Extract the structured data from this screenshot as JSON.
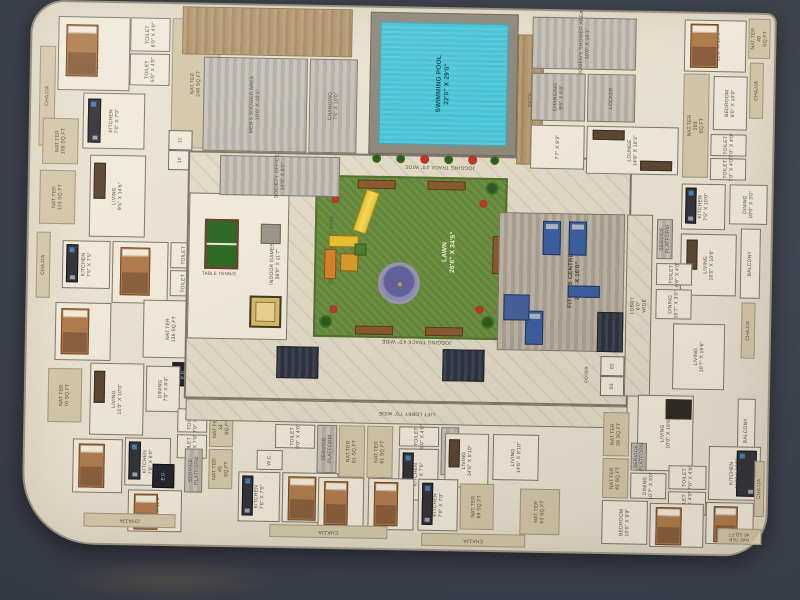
{
  "amen": {
    "pool": "SWIMMING POOL\n22'0\" X 29'0\"",
    "deck": "DECK",
    "lawn": "LAWN\n26'6\" X 34'5\"",
    "jog": "JOGGING TRACK 4'0\" WIDE",
    "indoor": "INDOOR GAMES\n38'0\" X 11'7\"",
    "tt": "TABLE TENNIS",
    "fitness": "FITNESS CENTRE\n24'0\" X 16'0\"",
    "mens": "MEN'S SHOWER AREA\n10'0\" X 10'1\"",
    "womens": "WOMEN'S SHOWER AREA\n10'0\" X 10'1\"",
    "chgm": "CHANGING\n7'5\" X 10'0\"",
    "chgw": "CHANGING\n9'5\" X 6'8\"",
    "locker": "LOCKER",
    "lounge": "LOUNGE\n14'8\" X 10'3\"",
    "office": "SOCIETY OFFICE\n14'0\" X 8'0\"",
    "r77": "7'7\" X 9'3\"",
    "liftlobby": "LIFT LOBBY 7'0\" WIDE",
    "lobby": "LOBBY 6'0\" WIDE",
    "foyer": "FOYER",
    "lift02": "02",
    "lift03": "03",
    "lift10": "10",
    "lift11": "11",
    "ed": "E.D."
  },
  "tl": {
    "bed": "BEDROOM\n10'0\" X 10'0\"",
    "kit": "KITCHEN\n7'0\" X 7'0\"",
    "t1": "TOILET\n6'0\" X 4'0\"",
    "t2": "TOILET\n5'0\" X 4'0\"",
    "nat248": "NAT.TER\n248 SQ.FT",
    "chajja": "CHAJJA"
  },
  "left": {
    "nat108": "NAT.TER\n108 SQ.FT",
    "nat113": "NAT.TER\n113 SQ.FT",
    "living": "LIVING\n9'5\" X 14'6\"",
    "kit": "KITCHEN\n7'5\" X 7'5\"",
    "bed": "BEDROOM\n9'0\" X 10'0\"",
    "t1": "TOILET\n6'0\" X 4'0\"",
    "t2": "TOILET\n7'0\" X 4'0\"",
    "nat136": "NAT.TER\n136 SQ.FT",
    "bed2": "BEDROOM\n10'0\" X 10'0\"",
    "chajja": "CHAJJA"
  },
  "bl": {
    "nat70": "NAT.TER\n70 SQ.FT",
    "living": "LIVING\n15'0\" X 10'0\"",
    "dining": "DINING\n7'0\" X 8'0\"",
    "kit": "KITCHEN\n7'8\" X 8'0\"",
    "bed1": "BEDROOM\n9'0\" X 8'0\"",
    "bed2": "BED ROOM\n10'0\" X 11'3\"",
    "t1": "TOILET\n7'0\" X 4'0\"",
    "t2": "TOILET\n4'0\" X 7'0\"",
    "nat34": "NAT.TER\n34 SQ.FT",
    "nat45": "NAT.TER\n45 SQ.FT",
    "sp": "SERVICE\nPLATFORM",
    "chajja": "CHAJJA"
  },
  "bm": {
    "t1": "TOILET\n8'0\" X 4'0\"",
    "sp1": "SERVICE\nPLATFORM",
    "nat81a": "NAT.TER\n81 SQ.FT",
    "nat81b": "NAT.TER\n81 SQ.FT",
    "wc": "W.C.",
    "kit1": "KITCHEN\n7'8\" X 7'0\"",
    "bed": "BEDROOM\n10'0\" X 10'0\"",
    "living1": "LIVING\n14'6\" X 8'10\"",
    "living2": "LIVING\n14'6\" X 8'10\"",
    "kit2": "KITCHEN\n7'5\" X 7'0\"",
    "t2": "TOILET\n6'0\" X 4'0\"",
    "sp2": "SERVICE\nPLATFORM"
  },
  "bm2": {
    "bed1": "BEDROOM\n10'0\" X 8'0\"",
    "bed2": "BEDROOM\n10'0\" X 8'0\"",
    "kit": "KITCHEN\n7'0\" X 7'0\"",
    "chajja1": "CHAJJA",
    "chajja2": "CHAJJA",
    "nat69": "NAT.TER\n69 SQ.FT",
    "nat83": "NAT.TER\n83 SQ.FT"
  },
  "br": {
    "living": "LIVING\n10'0\" X 16'6\"",
    "balcony": "BALCONY",
    "dining": "DINING\n10'7\" X 3'0\"",
    "nat39": "NAT.TER\n39 SQ.FT",
    "nat45": "NAT.TER\n45 SQ.FT",
    "sp": "SERVICE\nPLATFORM",
    "t1": "TOILET\n7'0\" X 4'0\"",
    "t2": "TOILET\n7'0\" X 4'0\"",
    "kit": "KITCHEN\n11'9\" X 10'9\"",
    "bed1": "BEDROOM\n10'0\" X 9'9\"",
    "bed2": "BEDROOM\n11'9\" X 10'3\"",
    "bed3": "BEDROOM\n9'0\" X 10'0\"",
    "nat46": "NAT.TER\n46 SQ.FT",
    "chajja": "CHAJJA"
  },
  "right": {
    "sp": "SERVICE\nPLATFORM",
    "toilet": "TOILET\n6'8\" X 4'0\"",
    "dining": "DINING\n10'7\" X 3'0\"",
    "living": "LIVING\n10'7\" X 16'6\""
  },
  "tr": {
    "bed1": "BEDROOM\n11'8\" X 10'3\"",
    "nat48": "NAT.TER\n48 SQ.FT",
    "chajja1": "CHAJJA",
    "bed2": "BEDROOM\n9'0\" X 10'0\"",
    "t1": "TOILET\n7'0\" X 4'0\"",
    "t2": "TOILET\n7'0\" X 4'0\"",
    "kit": "KITCHEN\n7'5\" X 10'0\"",
    "dining": "DINING\n10'0\" X 3'0\"",
    "living": "LIVING\n10'0\" X 10'6\"",
    "balcony": "BALCONY",
    "chajja2": "CHAJJA",
    "nat203": "NAT.TER\n203 SQ.FT"
  }
}
